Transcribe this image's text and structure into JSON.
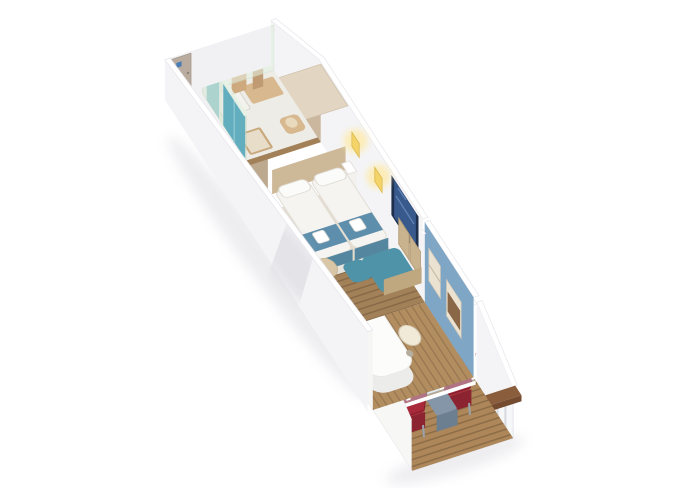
{
  "scene": {
    "type": "3d-cabin-floor-plan",
    "description": "Isometric cutaway rendering of a cruise ship balcony stateroom, no visible text",
    "background": "#ffffff"
  },
  "colors": {
    "wall": "#f4f4f7",
    "wall_inner": "#f7f7f5",
    "wall_top": "#ffffff",
    "end_wall": "#f1f1f4",
    "door_panel": "#b9ac9e",
    "door_sign": "#4a7fb5",
    "floor_wood": "#a28058",
    "carpet": "#e4dccd",
    "bathroom_floor": "#edece6",
    "bathroom_glass": "#d8e7d4",
    "bathroom_back_glass": "#e3eedf",
    "teal_door": "#62aebf",
    "teal_door_light": "#79bcc9",
    "fixture_tan": "#d7b88f",
    "fixture_tan_dark": "#c9a87c",
    "towel_tan": "#cfa97e",
    "wardrobe_front": "#cbb79d",
    "wardrobe_side": "#bda98e",
    "wardrobe_top": "#e2d6c3",
    "headboard": "#cdb898",
    "duvet": "#f6f4f0",
    "duvet_edge": "#e8e4dd",
    "runner": "#5d8fac",
    "runner_edge": "#54869f",
    "pillow": "#fbfbf9",
    "towel_white": "#ffffff",
    "nightstand": "#ffffff",
    "lamp": "#f4d469",
    "lamp_glow": "#ffe9a0",
    "tv_frame": "#1e2f4d",
    "tv_screen": "#37598c",
    "sofa_seat": "#4f93a9",
    "sofa_cushion": "#c9b28e",
    "sofa_arm": "#bfa77f",
    "pouf": "#d8c6a6",
    "partition": "#f3f3f6",
    "glass": "#a9c3d6",
    "veranda_wall": "#7fa6c5",
    "veranda_floor": "#b28d60",
    "lounger": "#fcfcfb",
    "lounger_shade": "#ececea",
    "lounger_back": "#f7f7f5",
    "side_table": "#f1ead9",
    "mounted_unit": "#ece2d2",
    "mounted_slats": "#8a6747",
    "slider_glass": "#bcd1df",
    "deck": "#ad8659",
    "chair_red": "#a8293a",
    "chair_red_dark": "#8c2330",
    "chair_frame": "#9aa2ac",
    "balcony_table": "#8496a7",
    "balcony_table_side": "#6c7f90",
    "rail_face": "#f6f7f9",
    "rail_cap": "#8a5d3c",
    "rail_cap_side": "#744b2f",
    "shadow": "#dcdce2"
  },
  "areas": {
    "entry": {
      "label": "Entry hallway",
      "objects": [
        "cabin-door",
        "door-sign",
        "wood-plank-floor"
      ]
    },
    "bathroom": {
      "label": "Bathroom",
      "objects": [
        "glass-shower-walls",
        "teal-sliding-doors",
        "shower-tray",
        "vanity",
        "washbasin",
        "toilet",
        "hanging-towels"
      ]
    },
    "wardrobe": {
      "label": "Wardrobe",
      "objects": [
        "triple-door-closet"
      ]
    },
    "bedroom": {
      "label": "Bedroom",
      "objects": [
        "twin-bed-left",
        "twin-bed-right",
        "headboard",
        "pillows",
        "bed-runners",
        "folded-towels",
        "nightstand",
        "wall-lamp-left",
        "wall-lamp-right",
        "tv",
        "sofa-with-chaise",
        "floor-cushion"
      ]
    },
    "veranda": {
      "label": "Enclosed veranda",
      "objects": [
        "glass-door",
        "daybed-lounger",
        "oval-side-table",
        "wall-shelf-unit",
        "fold-down-wall-seat"
      ]
    },
    "balcony": {
      "label": "Open balcony",
      "objects": [
        "sliding-glass-doors",
        "deck-chair-left",
        "deck-chair-right",
        "balcony-side-table",
        "balustrade",
        "wooden-handrail"
      ]
    }
  }
}
